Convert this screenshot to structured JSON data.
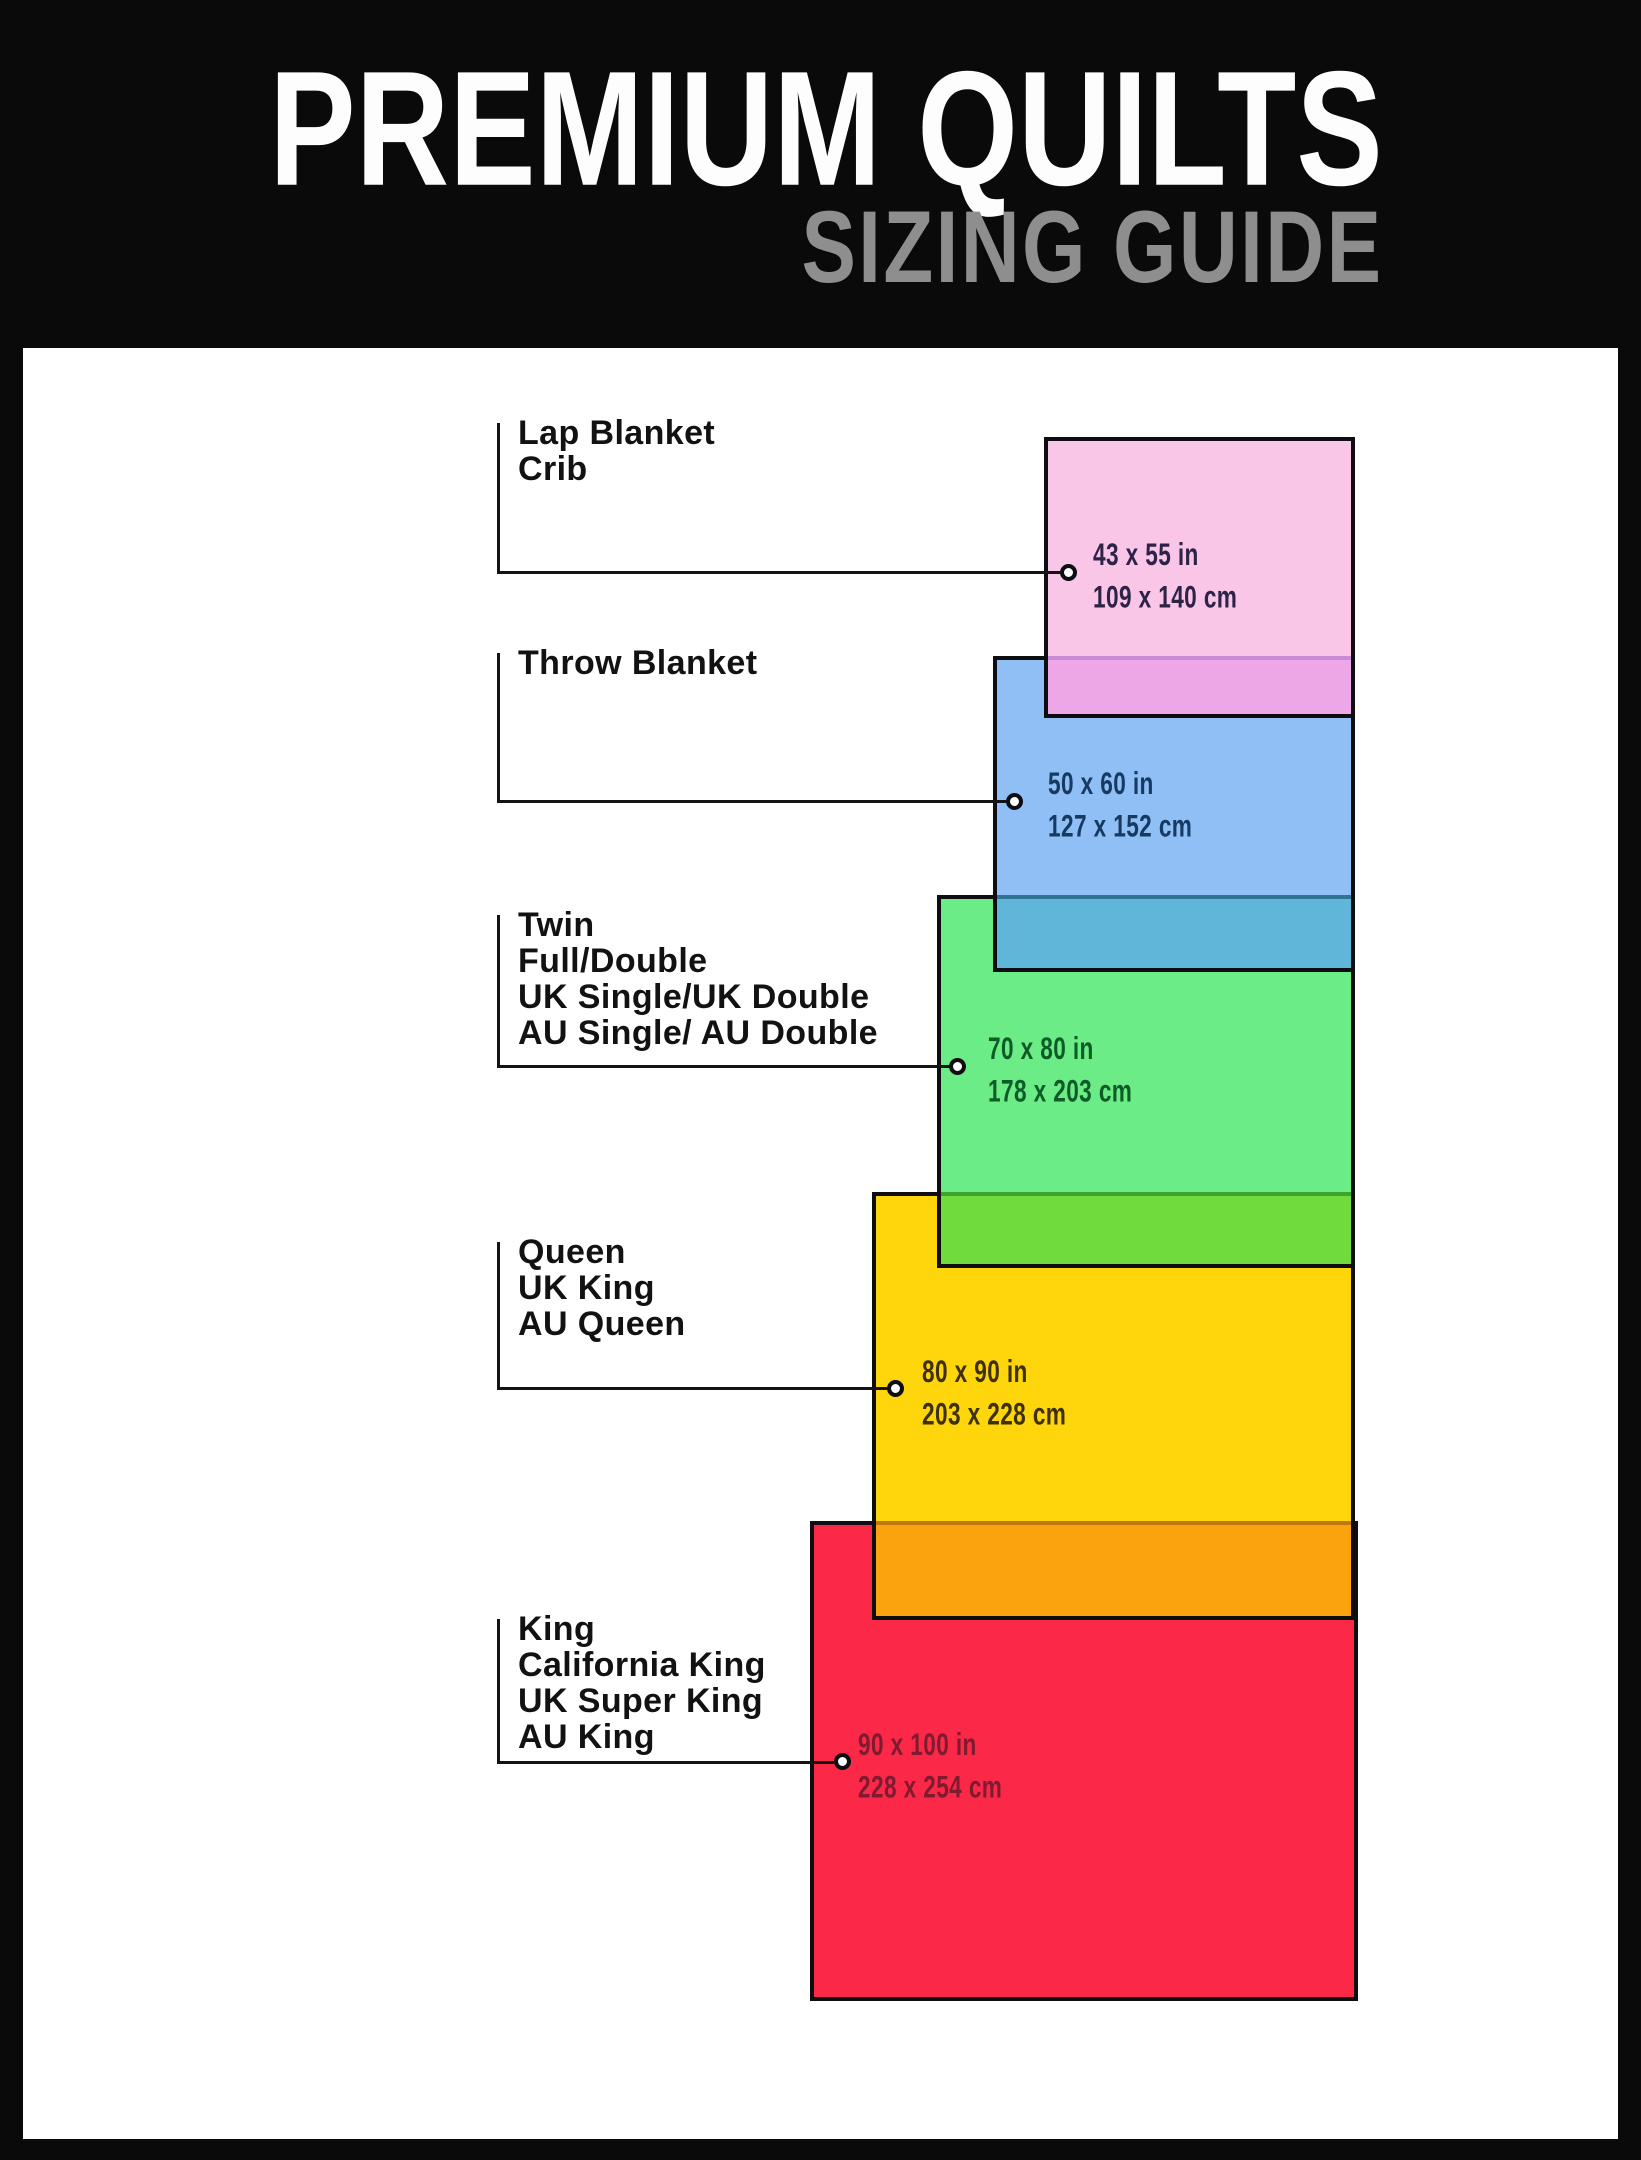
{
  "header": {
    "title": "PREMIUM QUILTS",
    "subtitle": "SIZING GUIDE",
    "title_color": "#fdfdfd",
    "subtitle_color": "#8e8e8e"
  },
  "frame": {
    "background": "#0a0a0a",
    "canvas": "#ffffff",
    "border_color": "#0d0d12",
    "line_color": "#141414"
  },
  "sizes": [
    {
      "key": "lap-crib",
      "labels": [
        "Lap Blanket",
        "Crib"
      ],
      "inches": "43 x 55 in",
      "cm": "109 x 140 cm",
      "fill": "#F9C6E8",
      "overlap_fill": "#EEA7E6",
      "overlap_edge": "#C98BD4",
      "text_color": "#2E2347"
    },
    {
      "key": "throw",
      "labels": [
        "Throw Blanket"
      ],
      "inches": "50 x 60 in",
      "cm": "127 x 152 cm",
      "fill": "#8FBFF4",
      "overlap_fill": "#5FB6D8",
      "overlap_edge": "#2F7490",
      "text_color": "#163A64"
    },
    {
      "key": "twin-full-double",
      "labels": [
        "Twin",
        "Full/Double",
        "UK Single/UK Double",
        "AU Single/ AU Double"
      ],
      "inches": "70 x 80 in",
      "cm": "178 x 203 cm",
      "fill": "#6CEC86",
      "overlap_fill": "#70DB3C",
      "overlap_edge": "#3FA42C",
      "text_color": "#0D5C28"
    },
    {
      "key": "queen",
      "labels": [
        "Queen",
        "UK King",
        "AU Queen"
      ],
      "inches": "80 x 90 in",
      "cm": "203 x 228 cm",
      "fill": "#FFD60B",
      "overlap_fill": "#FBA30F",
      "overlap_edge": "#C0780C",
      "text_color": "#3E3105"
    },
    {
      "key": "king",
      "labels": [
        "King",
        "California King",
        "UK Super King",
        "AU King"
      ],
      "inches": "90 x 100 in",
      "cm": "228 x 254 cm",
      "fill": "#FC2848",
      "text_color": "#7E1B30"
    }
  ]
}
